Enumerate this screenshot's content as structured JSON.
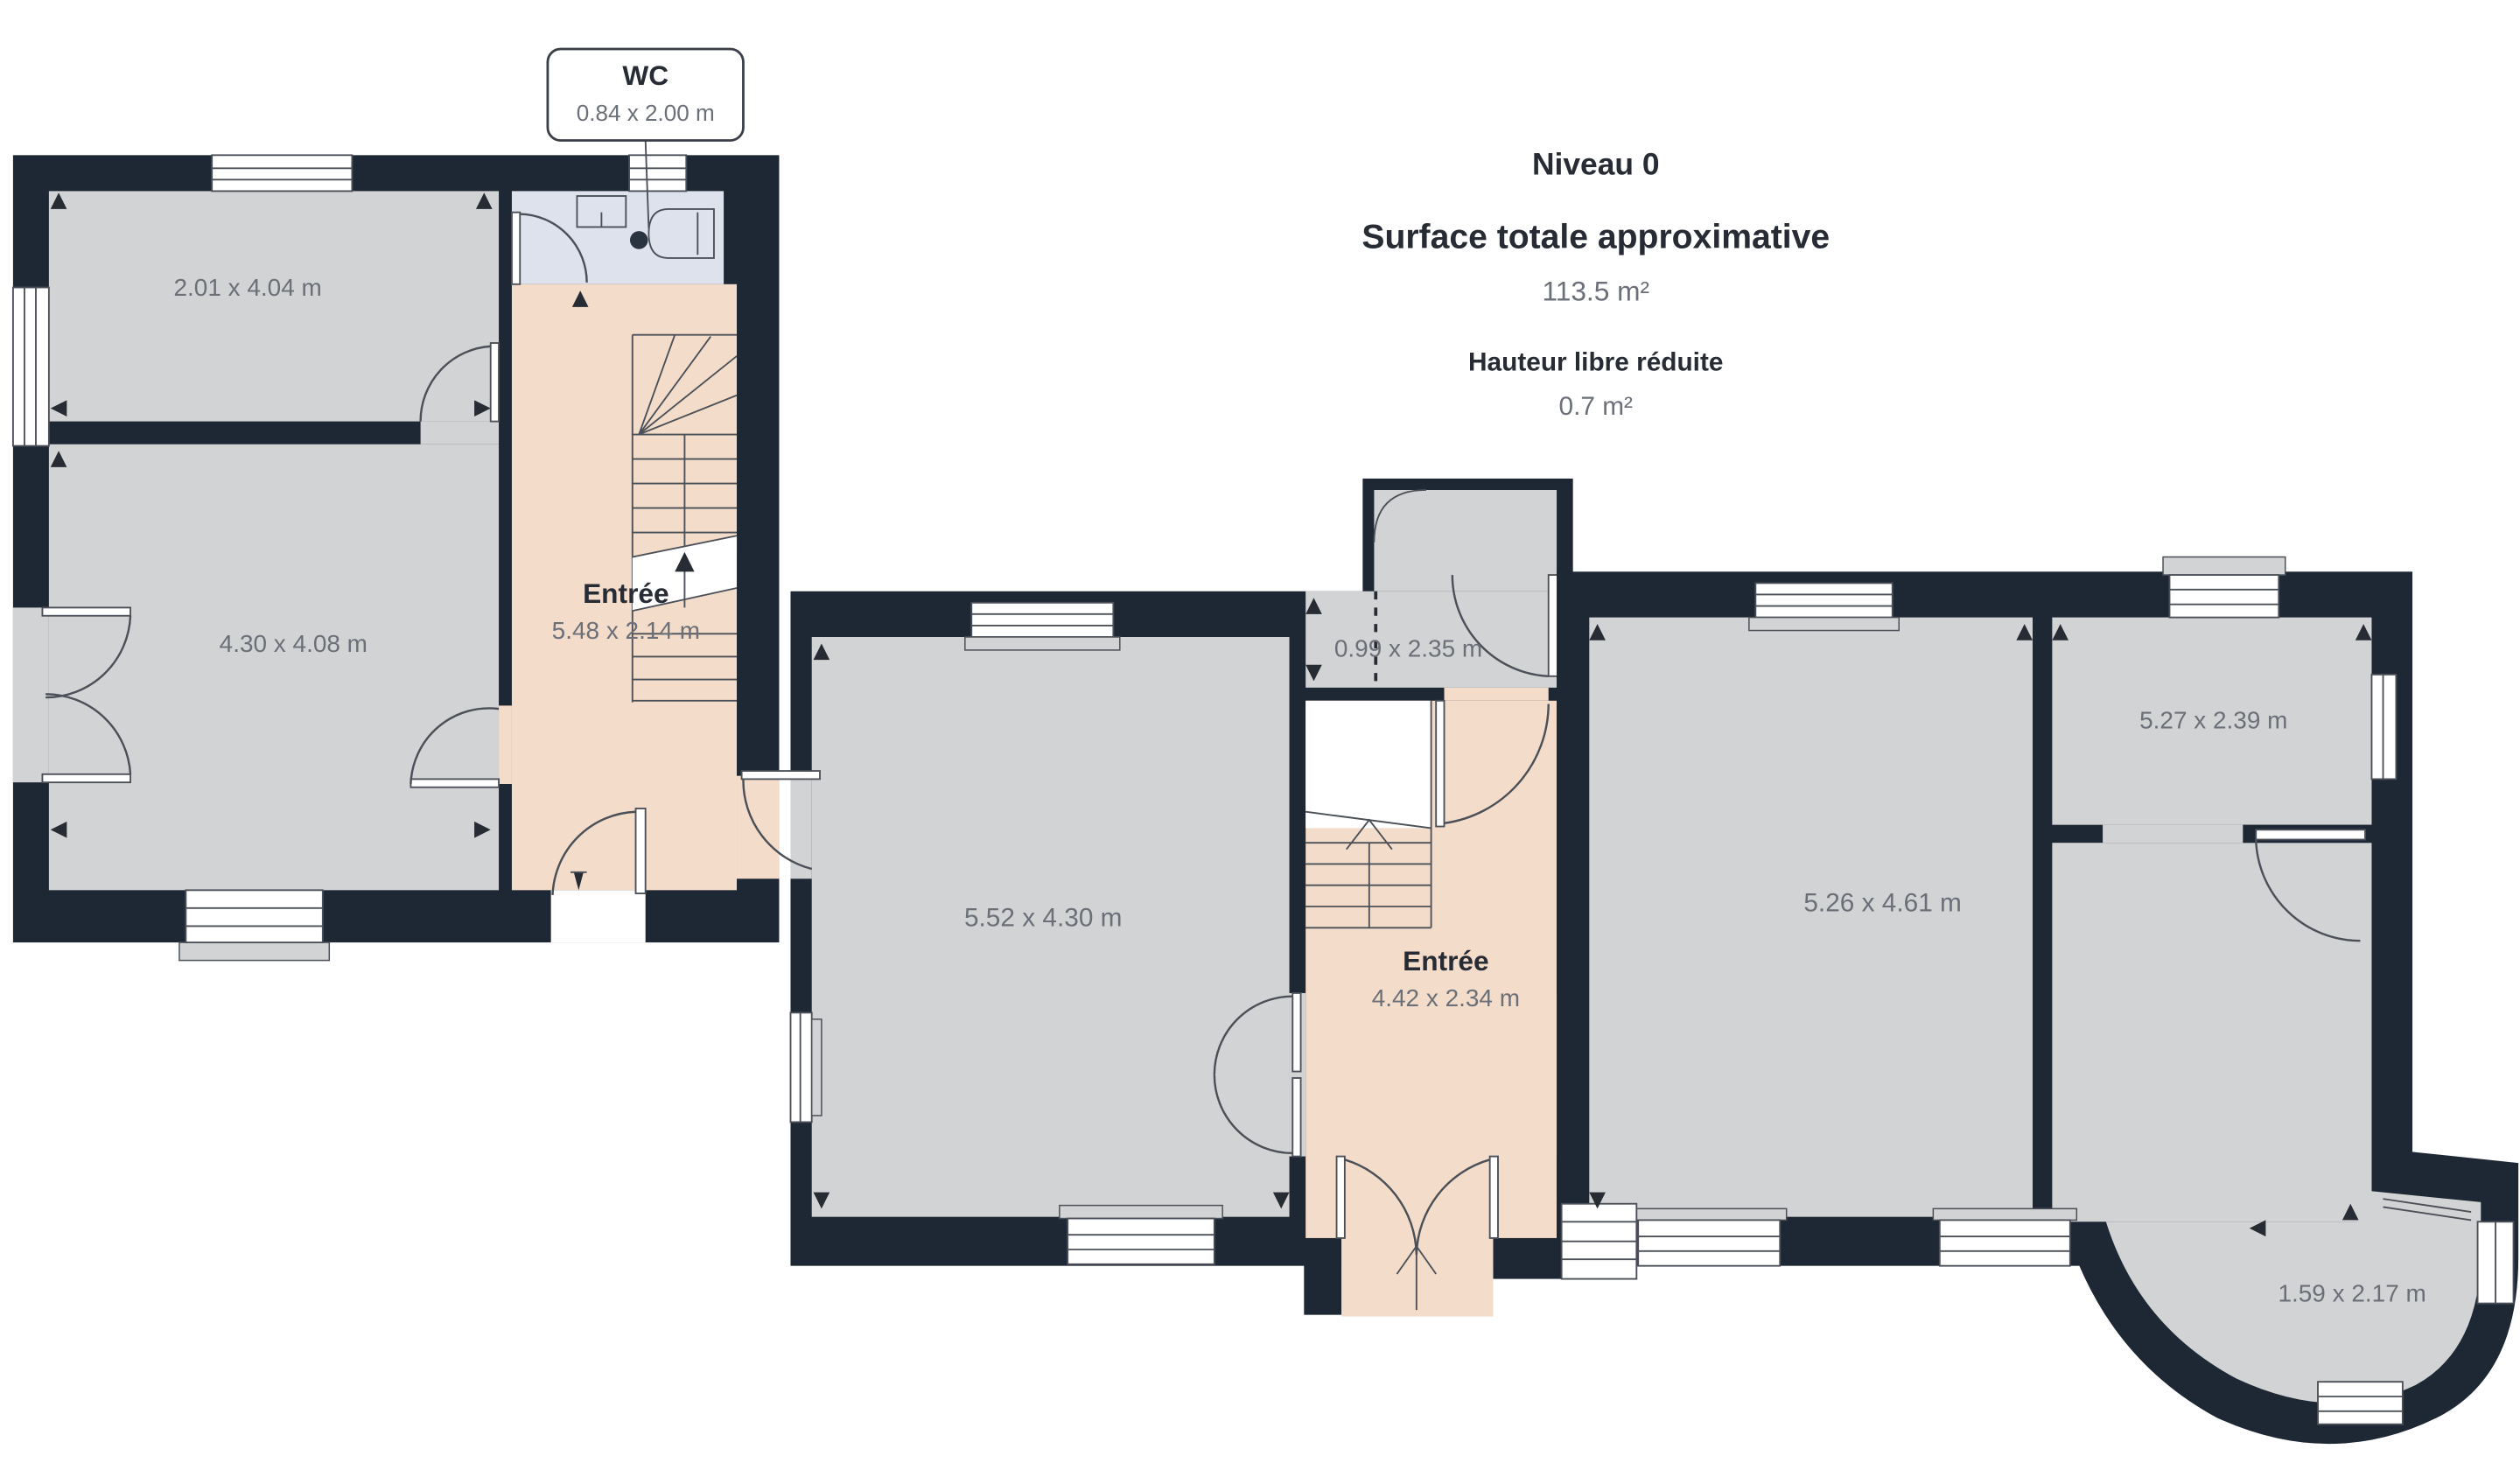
{
  "title_block": {
    "level": "Niveau 0",
    "surface_label": "Surface totale approximative",
    "surface_value": "113.5 m²",
    "height_label": "Hauteur libre réduite",
    "height_value": "0.7 m²"
  },
  "callout": {
    "title": "WC",
    "dims": "0.84 x 2.00 m"
  },
  "rooms": {
    "room_a": {
      "dims": "2.01 x 4.04 m"
    },
    "room_b": {
      "dims": "4.30 x 4.08 m"
    },
    "entree1": {
      "label": "Entrée",
      "dims": "5.48 x 2.14 m"
    },
    "salon": {
      "dims": "5.52 x 4.30 m"
    },
    "couloir": {
      "dims": "0.99 x 2.35 m"
    },
    "entree2": {
      "label": "Entrée",
      "dims": "4.42 x 2.34 m"
    },
    "sejour": {
      "dims": "5.26 x 4.61 m"
    },
    "chambre": {
      "dims": "5.27 x 2.39 m"
    },
    "bow": {
      "dims": "1.59 x 2.17 m"
    }
  },
  "colors": {
    "wall": "#1e2734",
    "floor": "#d2d3d4",
    "circulation": "#f4dcca",
    "wet_room": "#dee2ec",
    "stroke": "#4b5058",
    "dim_text": "#6a6f78",
    "dark_text": "#262b34"
  },
  "icons": {
    "stairs_up_arrow": "up-arrow",
    "entry_arrow": "up-arrow",
    "reduced_height_marker": "dashed-line"
  }
}
